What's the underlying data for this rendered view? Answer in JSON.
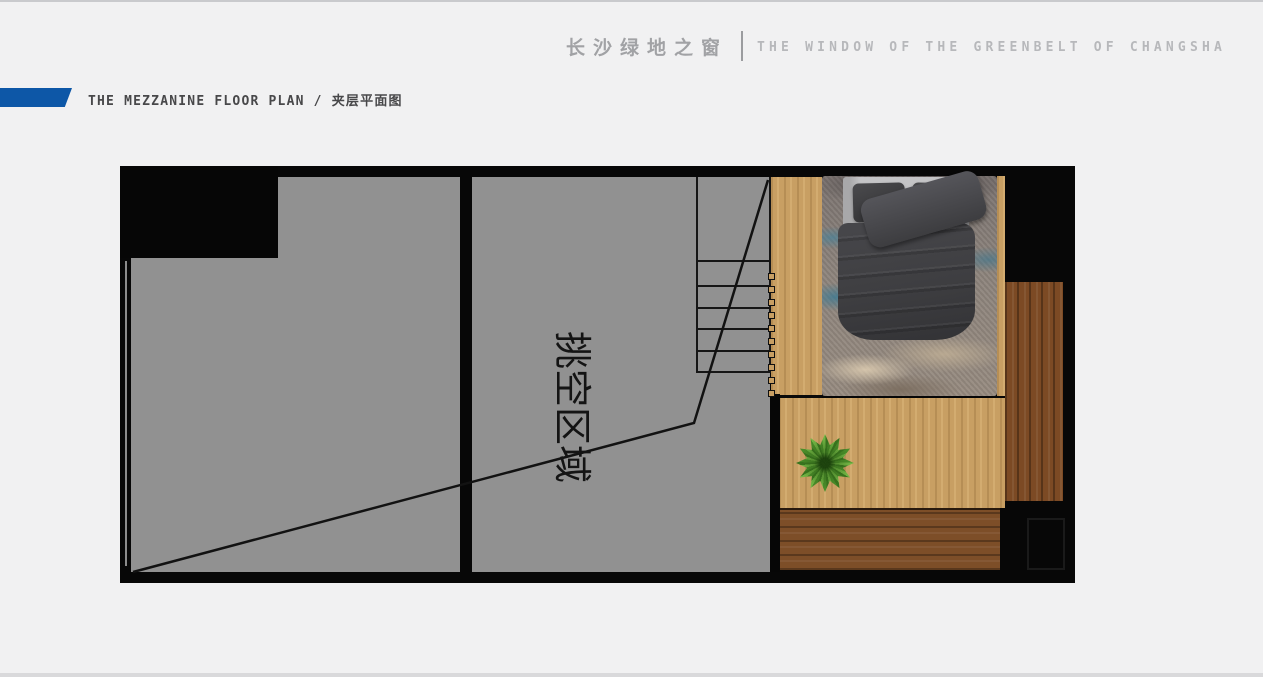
{
  "header": {
    "brand_cn": "长沙绿地之窗",
    "brand_en": "THE WINDOW OF THE GREENBELT OF CHANGSHA"
  },
  "title_bar": {
    "text": "THE MEZZANINE FLOOR PLAN / 夹层平面图"
  },
  "floor_plan": {
    "void_area_label": "挑空区域"
  },
  "colors": {
    "accent_blue": "#0d57a7",
    "wall_black": "#070707",
    "floor_gray": "#919191",
    "light_wood": "#c89f63",
    "dark_wood": "#7c4a24",
    "page_background": "#f1f1f2",
    "header_text_gray": "#b7b8bb",
    "title_text": "#48484a"
  }
}
